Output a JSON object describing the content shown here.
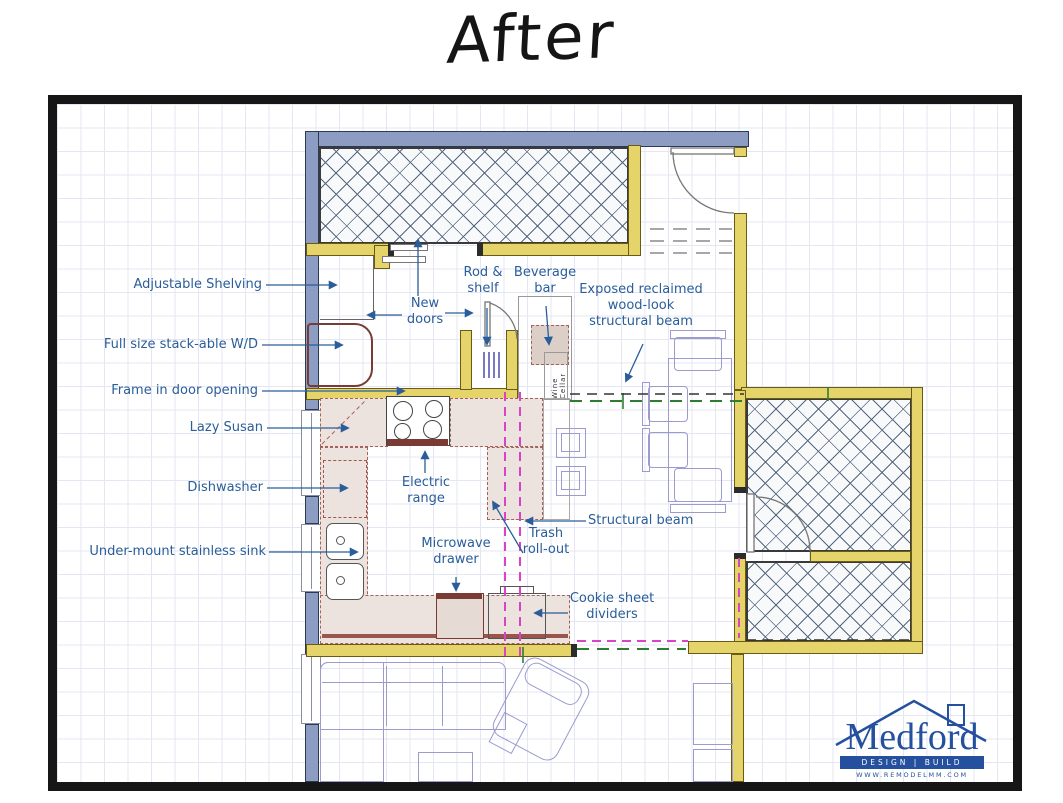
{
  "title": "After",
  "plan": {
    "annotations": {
      "adjustable_shelving": "Adjustable Shelving",
      "stackable_wd": "Full size stack-able W/D",
      "frame_in_door": "Frame in door opening",
      "lazy_susan": "Lazy Susan",
      "dishwasher": "Dishwasher",
      "undermount_sink": "Under-mount stainless sink",
      "new_doors": "New\ndoors",
      "rod_shelf": "Rod &\nshelf",
      "beverage_bar": "Beverage\nbar",
      "exposed_beam": "Exposed reclaimed\nwood-look\nstructural beam",
      "electric_range": "Electric\nrange",
      "structural_beam": "Structural beam",
      "trash_rollout": "Trash\nroll-out",
      "microwave_drawer": "Microwave\ndrawer",
      "cookie_sheet_dividers": "Cookie sheet\ndividers",
      "wine_cellar": "Wine Cellar"
    }
  },
  "logo": {
    "name": "Medford",
    "tagline": "DESIGN | BUILD",
    "url": "WWW.REMODELMM.COM"
  },
  "colors": {
    "exterior_wall": "#8d9cc2",
    "new_wall": "#e4d46a",
    "beam_magenta": "#d844c4",
    "beam_green": "#2f7d33",
    "annotation_blue": "#2a5d99",
    "logo_blue": "#24509e",
    "counter_tan": "#ece3de"
  }
}
